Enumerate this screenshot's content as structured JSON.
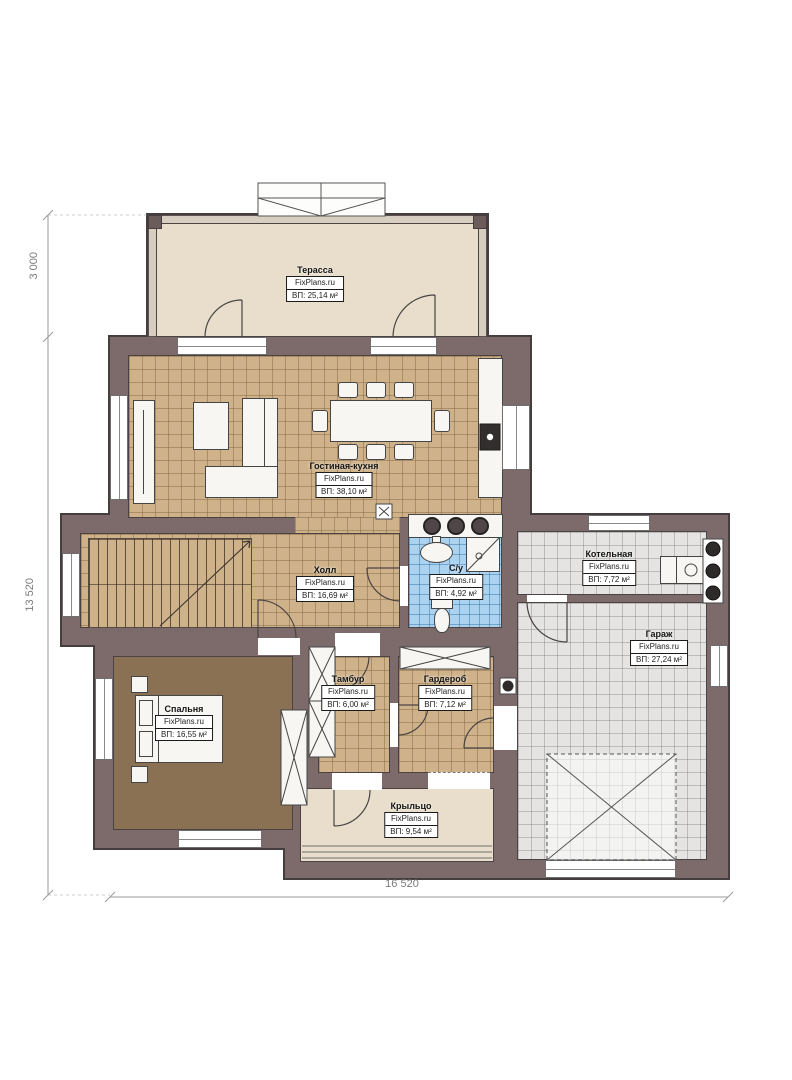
{
  "plan": {
    "rooms": {
      "terrace": {
        "name": "Терасса",
        "brand": "FixPlans.ru",
        "area": "ВП: 25,14 м²"
      },
      "living": {
        "name": "Гостиная-кухня",
        "brand": "FixPlans.ru",
        "area": "ВП: 38,10 м²"
      },
      "hall": {
        "name": "Холл",
        "brand": "FixPlans.ru",
        "area": "ВП: 16,69 м²"
      },
      "wc": {
        "name": "С/у",
        "brand": "FixPlans.ru",
        "area": "ВП: 4,92 м²"
      },
      "boiler": {
        "name": "Котельная",
        "brand": "FixPlans.ru",
        "area": "ВП: 7,72 м²"
      },
      "garage": {
        "name": "Гараж",
        "brand": "FixPlans.ru",
        "area": "ВП: 27,24 м²"
      },
      "bedroom": {
        "name": "Спальня",
        "brand": "FixPlans.ru",
        "area": "ВП: 16,55 м²"
      },
      "tambour": {
        "name": "Тамбур",
        "brand": "FixPlans.ru",
        "area": "ВП: 6,00 м²"
      },
      "wardrobe": {
        "name": "Гардероб",
        "brand": "FixPlans.ru",
        "area": "ВП: 7,12 м²"
      },
      "porch": {
        "name": "Крыльцо",
        "brand": "FixPlans.ru",
        "area": "ВП: 9,54 м²"
      }
    },
    "dimensions": {
      "terrace_depth": "3 000",
      "total_depth": "13 520",
      "total_width": "16 520"
    },
    "colors": {
      "wall": "#7d6a6a",
      "floor_tan": "#cfb28a",
      "floor_blue": "#abd3f0",
      "floor_gray": "#e5e4e2",
      "floor_bedroom": "#8a7154",
      "terrace_floor": "#e8decb"
    }
  }
}
